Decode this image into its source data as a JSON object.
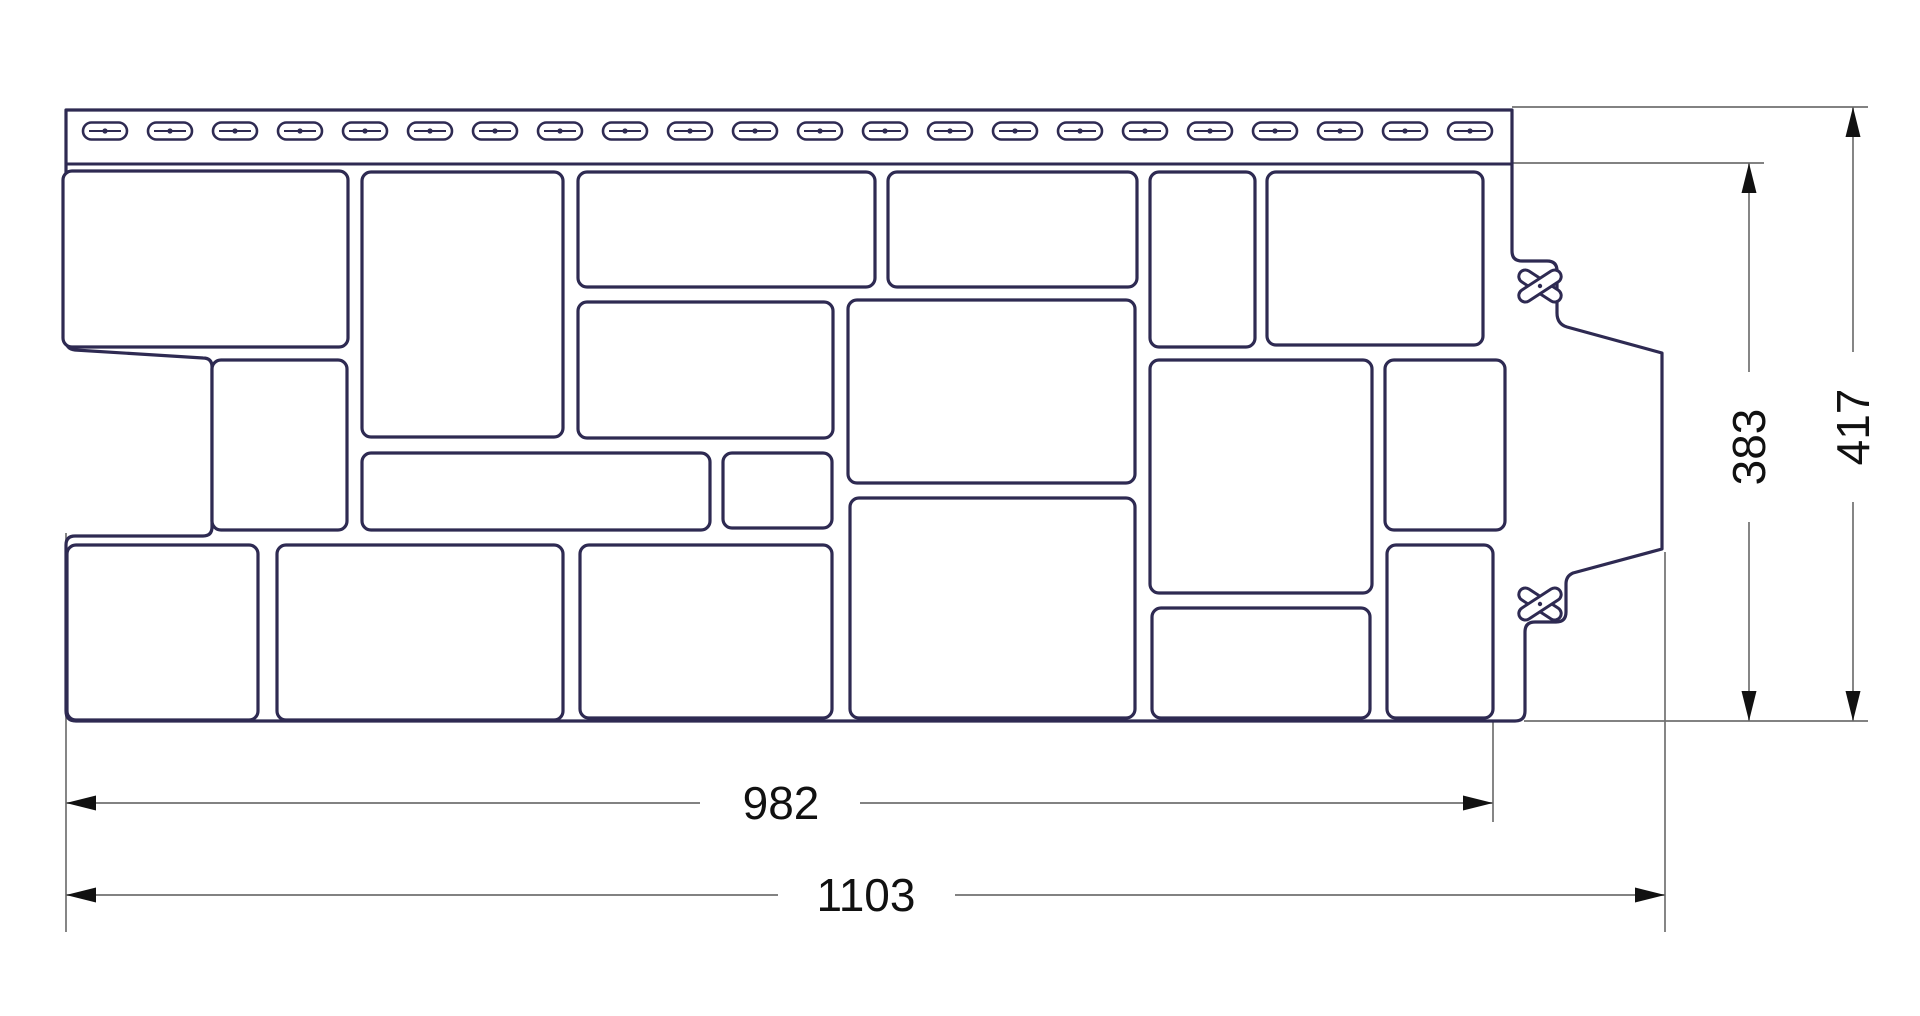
{
  "drawing": {
    "kind": "technical-line-drawing",
    "subject": "facade-panel-profile",
    "units_shown": "mm (implied, unlabeled)"
  },
  "colors": {
    "background": "#ffffff",
    "panel_line": "#2e2a52",
    "dimension_line": "#707070",
    "dimension_text": "#111111"
  },
  "dimensions": {
    "width_nominal": {
      "value": "982"
    },
    "width_overall": {
      "value": "1103"
    },
    "height_nominal": {
      "value": "383"
    },
    "height_overall": {
      "value": "417"
    }
  },
  "geometry": {
    "outline_path": "M 66,110 L 1512,110 L 1512,251 Q 1512,261 1522,261 L 1547,261 Q 1557,261 1557,271 L 1557,313 Q 1557,324 1567,327 L 1662,353 L 1662,549 L 1573,573 Q 1566,576 1566,584 L 1566,612 Q 1566,622 1556,622 L 1535,622 Q 1525,622 1525,632 L 1525,711 Q 1525,721 1515,721 L 76,721 Q 66,721 66,711 L 66,545 Q 66,536 75,536 L 203,536 Q 212,536 212,527 L 212,367 Q 212,358 203,358 L 75,350 Q 66,349 66,340 Z",
    "nail_strip": {
      "bottom_line": [
        66,
        164,
        1512,
        164
      ],
      "slots": {
        "count": 22,
        "first_center_x": 105,
        "pitch": 65,
        "center_y": 131,
        "width": 44,
        "height": 17
      }
    },
    "stones": [
      [
        63,
        171,
        285,
        176
      ],
      [
        362,
        172,
        201,
        265
      ],
      [
        578,
        172,
        297,
        115
      ],
      [
        888,
        172,
        249,
        115
      ],
      [
        1150,
        172,
        105,
        175
      ],
      [
        1267,
        172,
        216,
        173
      ],
      [
        212,
        360,
        135,
        170
      ],
      [
        578,
        302,
        255,
        136
      ],
      [
        848,
        300,
        287,
        183
      ],
      [
        1150,
        360,
        222,
        233
      ],
      [
        1385,
        360,
        120,
        170
      ],
      [
        362,
        453,
        348,
        77
      ],
      [
        723,
        453,
        109,
        75
      ],
      [
        67,
        545,
        191,
        175
      ],
      [
        277,
        545,
        286,
        175
      ],
      [
        580,
        545,
        252,
        173
      ],
      [
        850,
        498,
        285,
        220
      ],
      [
        1152,
        608,
        218,
        110
      ],
      [
        1387,
        545,
        106,
        173
      ]
    ],
    "stone_corner_radius": 9,
    "clips": {
      "centers": [
        [
          1540,
          286
        ],
        [
          1540,
          604
        ]
      ],
      "arm_length": 48,
      "arm_width": 13,
      "angle_deg": 33
    },
    "extension_lines": [
      [
        66,
        533,
        66,
        932
      ],
      [
        1493,
        722,
        1493,
        822
      ],
      [
        1665,
        552,
        1665,
        932
      ],
      [
        1512,
        163,
        1764,
        163
      ],
      [
        1512,
        107,
        1868,
        107
      ],
      [
        1524,
        721,
        1868,
        721
      ]
    ],
    "dimension_lines": [
      {
        "key": "width_nominal",
        "name": "dimension-982",
        "orientation": "h",
        "pos": 803,
        "from": 66,
        "to": 1493,
        "gap": [
          700,
          860
        ],
        "label_at": [
          781,
          803
        ],
        "rotate": 0
      },
      {
        "key": "width_overall",
        "name": "dimension-1103",
        "orientation": "h",
        "pos": 895,
        "from": 66,
        "to": 1665,
        "gap": [
          778,
          955
        ],
        "label_at": [
          866,
          895
        ],
        "rotate": 0
      },
      {
        "key": "height_nominal",
        "name": "dimension-383",
        "orientation": "v",
        "pos": 1749,
        "from": 163,
        "to": 721,
        "gap": [
          372,
          522
        ],
        "label_at": [
          1749,
          447
        ],
        "rotate": -90
      },
      {
        "key": "height_overall",
        "name": "dimension-417",
        "orientation": "v",
        "pos": 1853,
        "from": 107,
        "to": 721,
        "gap": [
          352,
          502
        ],
        "label_at": [
          1853,
          427
        ],
        "rotate": -90
      }
    ],
    "arrow": {
      "length": 30,
      "half_width": 7.5
    }
  }
}
